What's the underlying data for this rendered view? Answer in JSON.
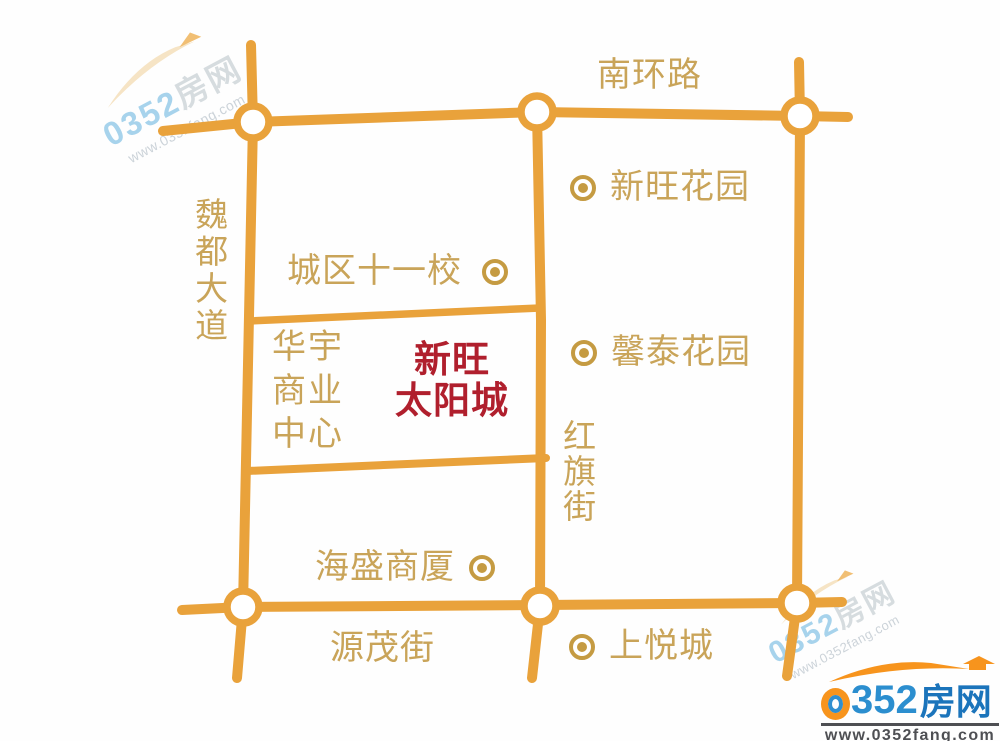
{
  "map": {
    "roads": {
      "south_ring": "南环路",
      "weidu_avenue": "魏都大道",
      "hongqi_street": "红旗街",
      "yuanmao_street": "源茂街"
    },
    "pois": {
      "xinwang_garden": "新旺花园",
      "city_no11_school": "城区十一校",
      "xintai_garden": "馨泰花园",
      "huayu_business_center": "华宇商业中心",
      "haisheng_building": "海盛商厦",
      "shangyue_city": "上悦城"
    },
    "project": {
      "line1": "新旺",
      "line2": "太阳城"
    }
  },
  "watermark": {
    "brand_num": "0352",
    "brand_cn": "房网",
    "url": "www.0352fang.com"
  },
  "logo": {
    "digits": "352",
    "brand_cn": "房网",
    "url": "www.0352fang.com"
  },
  "colors": {
    "road_orange": "#e9a23b",
    "label_tan": "#c9a459",
    "poi_gold": "#c59b42",
    "project_red": "#b01f2d",
    "logo_orange": "#f7941d",
    "logo_blue": "#1b74bb",
    "watermark_blue": "#a7d3ec"
  }
}
